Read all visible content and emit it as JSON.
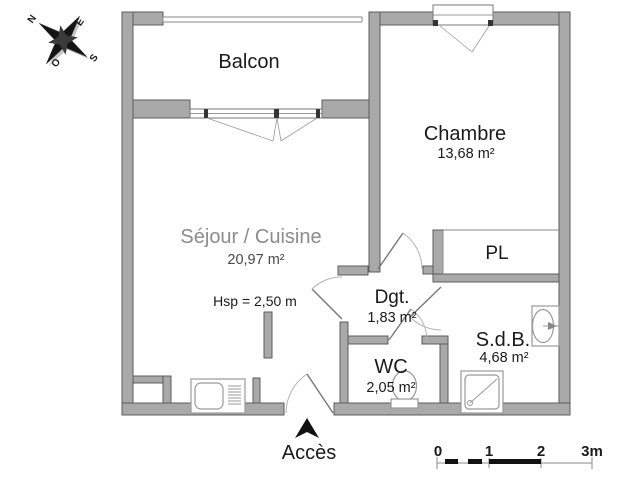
{
  "plan": {
    "rooms": {
      "balcon": {
        "name": "Balcon"
      },
      "chambre": {
        "name": "Chambre",
        "area": "13,68 m²"
      },
      "sejour": {
        "name": "Séjour / Cuisine",
        "area": "20,97 m²",
        "ceiling_height": "Hsp = 2,50 m"
      },
      "pl": {
        "name": "PL"
      },
      "dgt": {
        "name": "Dgt.",
        "area": "1,83 m²"
      },
      "wc": {
        "name": "WC",
        "area": "2,05 m²"
      },
      "sdb": {
        "name": "S.d.B.",
        "area": "4,68 m²"
      }
    },
    "entrance_label": "Accès",
    "compass": {
      "north": "N",
      "east": "E",
      "south": "S",
      "west": "O"
    },
    "scale_bar": {
      "ticks": [
        "0",
        "1",
        "2",
        "3m"
      ]
    },
    "colors": {
      "wall": "#a9a9a9",
      "wall_outline": "#5c5c5c",
      "fixture_line": "#999999",
      "text": "#1a1a1a",
      "watermark_text": "#8c8c8c",
      "accent_black": "#111111"
    }
  }
}
